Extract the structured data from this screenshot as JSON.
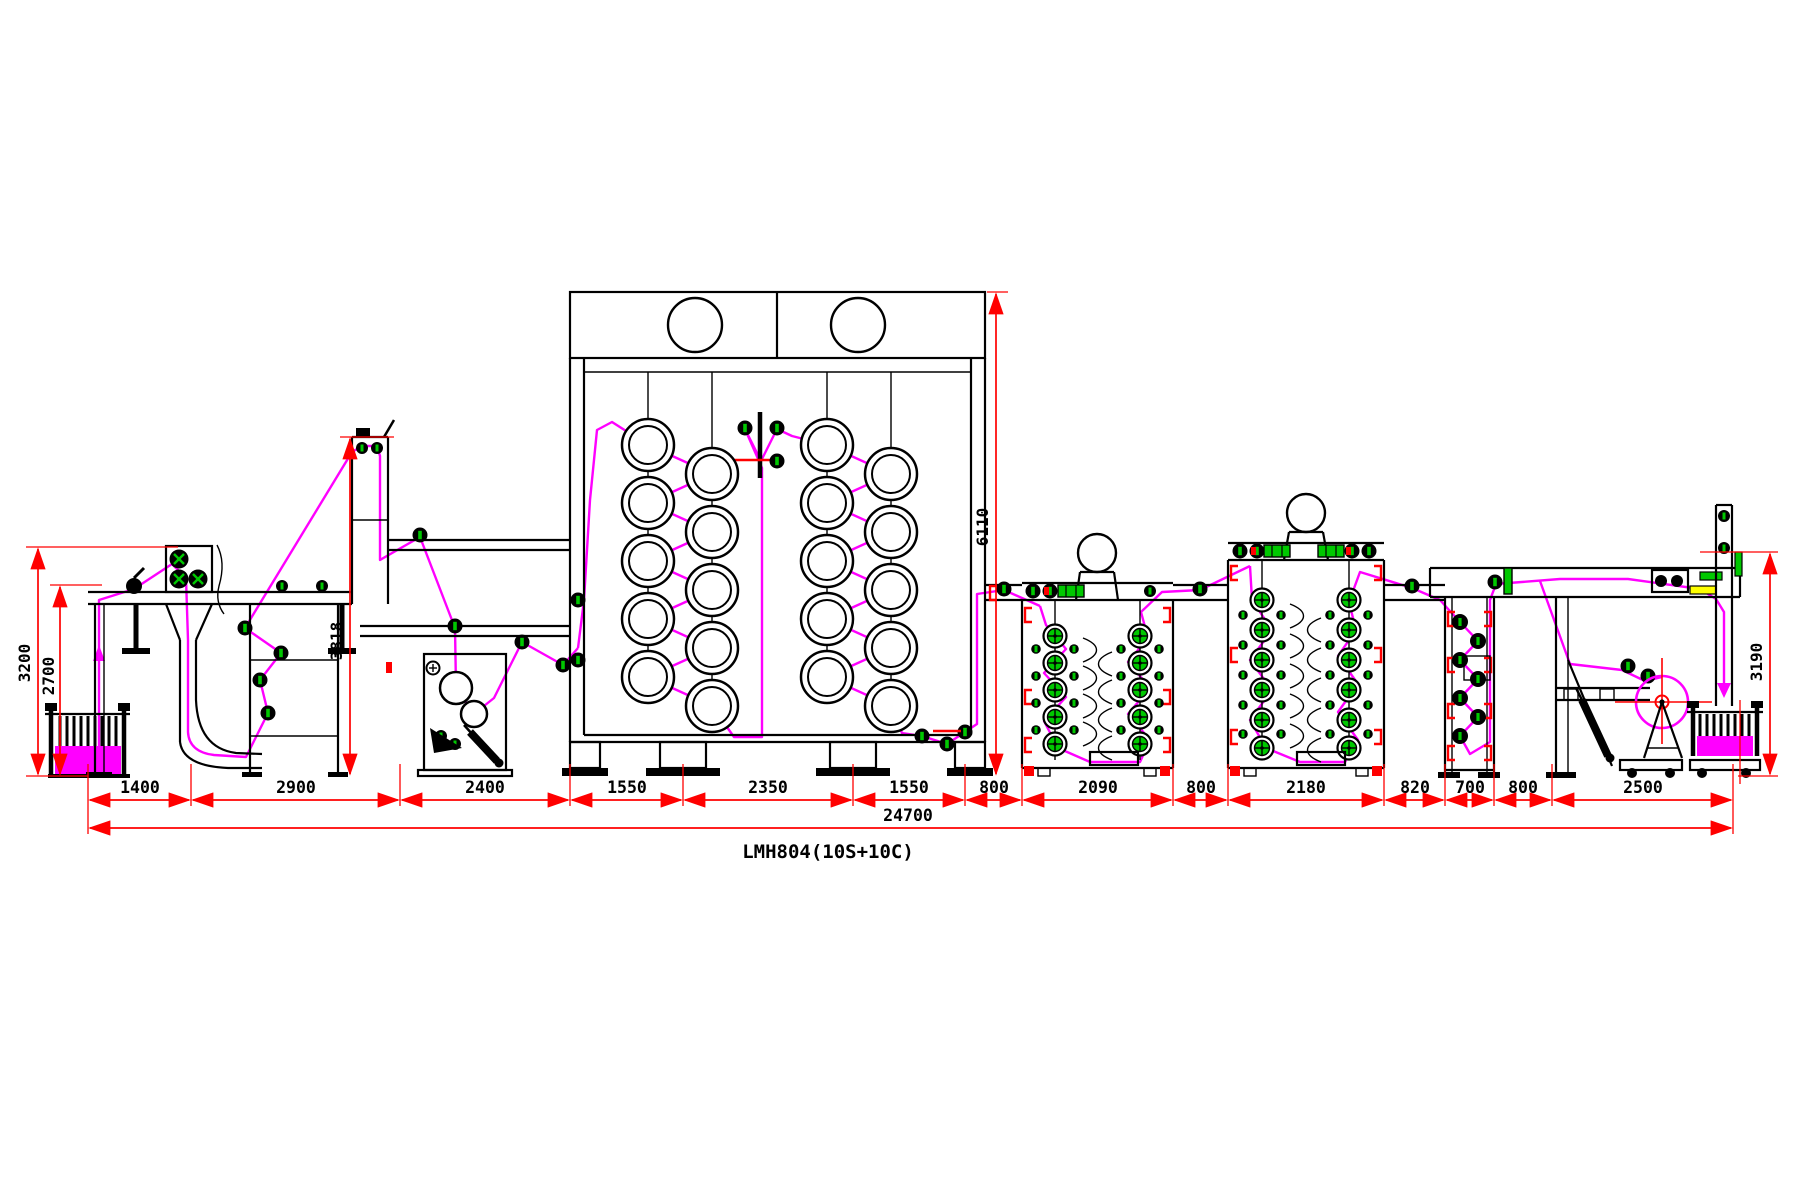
{
  "drawing": {
    "title": "LMH804(10S+10C)",
    "total_length": "24700",
    "section_dims": [
      "1400",
      "2900",
      "2400",
      "1550",
      "2350",
      "1550",
      "800",
      "2090",
      "800",
      "2180",
      "820",
      "700",
      "800",
      "2500"
    ],
    "height_dims": {
      "unwind_frame": "3200",
      "unwind_web": "2700",
      "feed_tower": "3818",
      "dryer": "6110",
      "outlet": "3190"
    },
    "colors": {
      "machine_line": "#000000",
      "web_path": "#FF00FF",
      "dimension_line": "#FF0000",
      "roller_accent": "#00C800",
      "background": "#FFFFFF"
    }
  }
}
